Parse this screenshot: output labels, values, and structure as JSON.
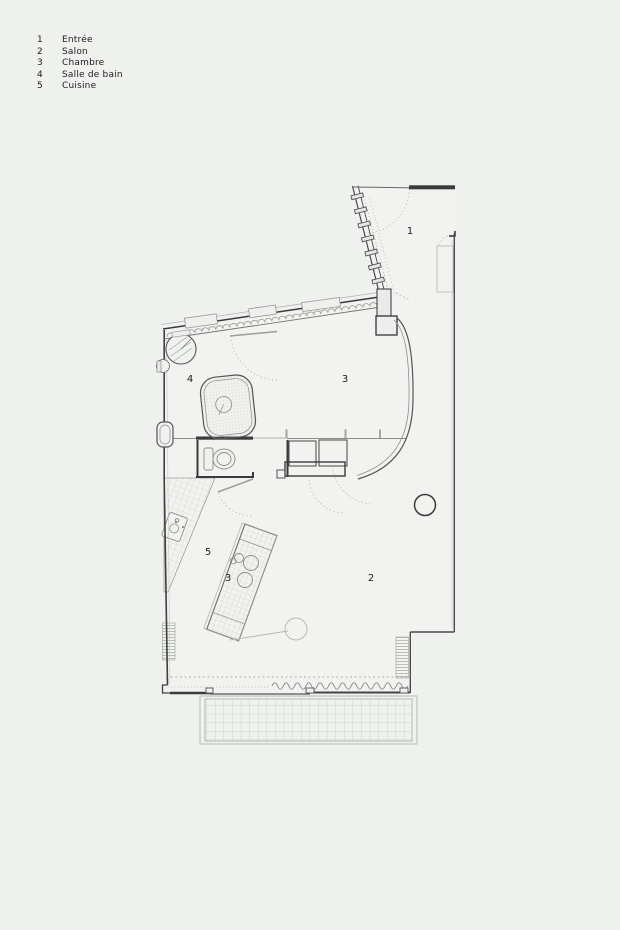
{
  "legend": {
    "items": [
      {
        "num": "1",
        "label": "Entrée"
      },
      {
        "num": "2",
        "label": "Salon"
      },
      {
        "num": "3",
        "label": "Chambre"
      },
      {
        "num": "4",
        "label": "Salle de bain"
      },
      {
        "num": "5",
        "label": "Cuisine"
      }
    ]
  },
  "plan": {
    "room_labels": {
      "entree": "1",
      "salon": "2",
      "chambre": "3",
      "salle_de_bain": "4",
      "cuisine": "5",
      "island": "3"
    }
  },
  "colors": {
    "background": "#eff1ee",
    "plan_interior": "#f2f3f0",
    "line_dark": "#3a3a3a",
    "line_medium": "#8a8e8a",
    "line_light": "#b5b9b5",
    "hatch": "#c9cdc9",
    "text": "#1c1c1c"
  }
}
